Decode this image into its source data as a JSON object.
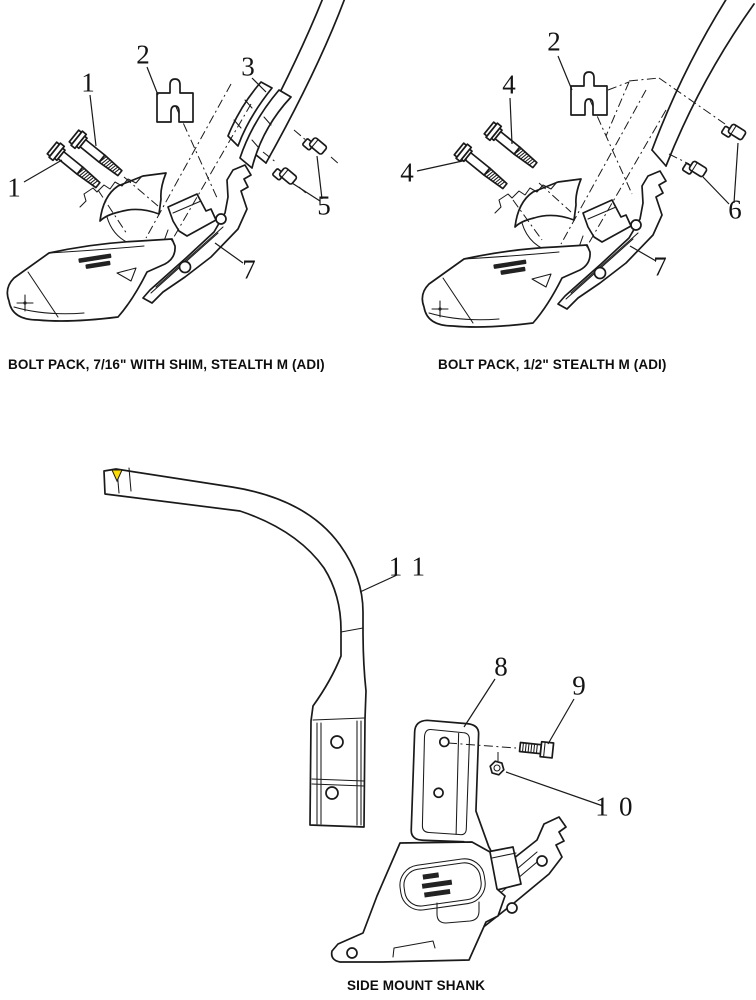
{
  "page": {
    "title": "Parts diagram page"
  },
  "colors": {
    "ink": "#1a1a1a",
    "paint_mark": "#ffdf00"
  },
  "diagrams": {
    "bolt_pack_716": {
      "caption": "BOLT PACK, 7/16\" WITH SHIM, STEALTH M (ADI)"
    },
    "bolt_pack_12": {
      "caption": "BOLT PACK, 1/2\" STEALTH M (ADI)"
    },
    "side_mount_shank": {
      "caption": "SIDE MOUNT SHANK"
    }
  },
  "callouts": [
    {
      "diagram": "bolt-pack-716",
      "label": "1",
      "x": 88,
      "y": 84
    },
    {
      "diagram": "bolt-pack-716",
      "label": "1",
      "x": 14,
      "y": 189
    },
    {
      "diagram": "bolt-pack-716",
      "label": "2",
      "x": 143,
      "y": 56
    },
    {
      "diagram": "bolt-pack-716",
      "label": "3",
      "x": 248,
      "y": 68
    },
    {
      "diagram": "bolt-pack-716",
      "label": "5",
      "x": 324,
      "y": 207
    },
    {
      "diagram": "bolt-pack-716",
      "label": "7",
      "x": 249,
      "y": 271
    },
    {
      "diagram": "bolt-pack-12",
      "label": "2",
      "x": 554,
      "y": 43
    },
    {
      "diagram": "bolt-pack-12",
      "label": "4",
      "x": 509,
      "y": 86
    },
    {
      "diagram": "bolt-pack-12",
      "label": "4",
      "x": 407,
      "y": 174
    },
    {
      "diagram": "bolt-pack-12",
      "label": "6",
      "x": 735,
      "y": 211
    },
    {
      "diagram": "bolt-pack-12",
      "label": "7",
      "x": 660,
      "y": 268
    },
    {
      "diagram": "side-mount-shank",
      "label": "11",
      "x": 412,
      "y": 568
    },
    {
      "diagram": "side-mount-shank",
      "label": "8",
      "x": 501,
      "y": 668
    },
    {
      "diagram": "side-mount-shank",
      "label": "9",
      "x": 579,
      "y": 687
    },
    {
      "diagram": "side-mount-shank",
      "label": "10",
      "x": 619,
      "y": 808
    }
  ]
}
